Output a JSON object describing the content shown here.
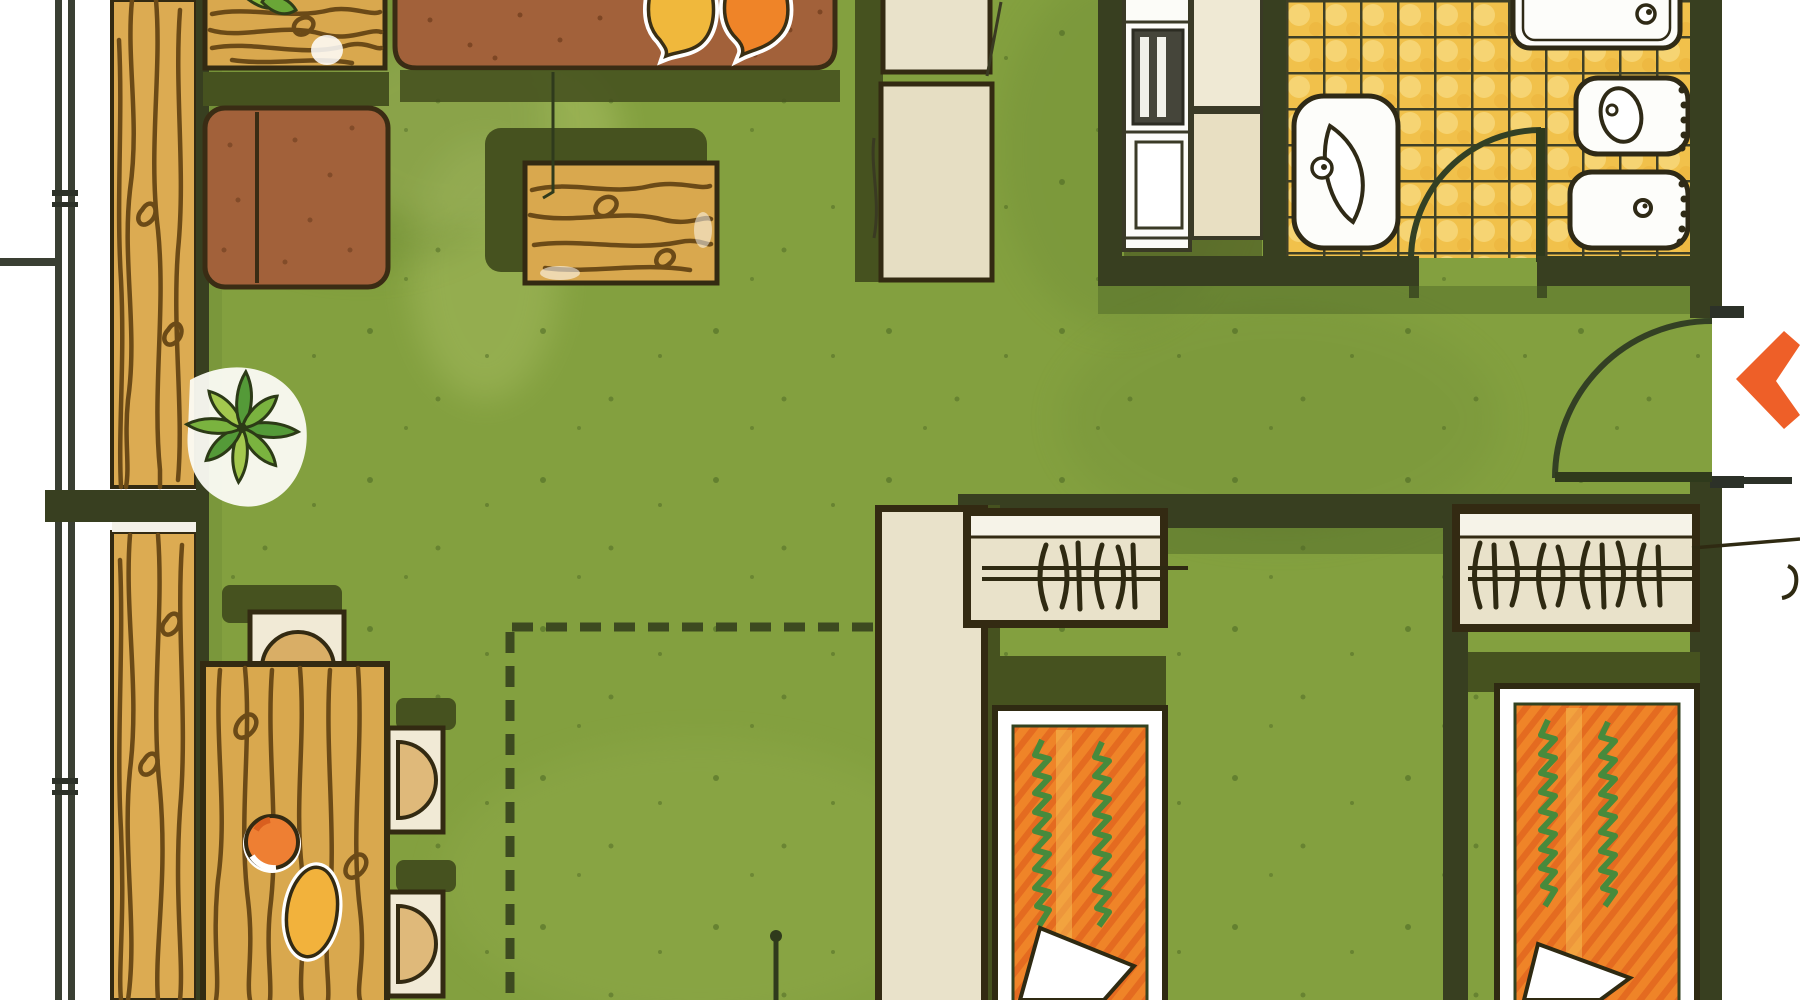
{
  "meta": {
    "kind": "hand-drawn apartment floor plan illustration",
    "view": "top-down marker rendering",
    "visible_text": "none (leader-line labels are cropped at image edges)"
  },
  "palette": {
    "floor_green": "#83a03f",
    "floor_green_light": "#9ab553",
    "shadow_olive": "#46521f",
    "wall_dark": "#383f20",
    "outline_dark": "#332a12",
    "wood_base": "#dcab52",
    "wood_grain": "#6b4a17",
    "upholstery_brown": "#a2613a",
    "bed_orange": "#ef8428",
    "bed_stripe": "#e2661f",
    "bed_zigzag_green": "#478a3c",
    "pillow_yellow": "#f0b83c",
    "pillow_orange": "#ef8428",
    "beige": "#e9e2ca",
    "beige_light": "#f1ead6",
    "tile_yellow": "#f1c14b",
    "tile_grid": "#3f4026",
    "fixture_white": "#fdfdfa",
    "arrow_orange": "#ee5f28",
    "plant_green": "#6fae3f",
    "exterior_white": "#ffffff"
  },
  "floor_plan": {
    "rooms": [
      {
        "id": "balcony",
        "features": [
          "wood plank decking strip",
          "outer railing with joint ticks",
          "dividing wall stub"
        ]
      },
      {
        "id": "living-room",
        "furniture": [
          "wood sideboard with plant leaves",
          "two-cushion brown armchair",
          "brown sofa-daybed with yellow and orange cushions",
          "wood coffee table with shadow"
        ]
      },
      {
        "id": "dining-area",
        "furniture": [
          "wood dining table",
          "head chair with half-round seat",
          "two side chairs with half-round seats",
          "round orange plate",
          "oval yellow platter"
        ],
        "annotation": "dashed L-shaped partition outline"
      },
      {
        "id": "hall-entrance",
        "furniture": [
          "beige storage column (upper)",
          "beige storage column (lower)"
        ],
        "features": [
          "entrance door with quarter-circle swing arc in right wall"
        ]
      },
      {
        "id": "kitchen",
        "furniture": [
          "white stove/oven unit with dark grill",
          "upper counter",
          "lower counter"
        ]
      },
      {
        "id": "bathroom",
        "furniture": [
          "bathtub with drain (cropped at top)",
          "wash basin with oval bowl and tap",
          "toilet with oval seat",
          "bidet with drain dot"
        ],
        "features": [
          "yellow tile grid floor",
          "door with quarter-circle swing arc"
        ]
      },
      {
        "id": "bedroom-1",
        "furniture": [
          "wardrobe with clothes-hanger symbols",
          "single bed, orange striped spread, green zigzags, white folded pillow"
        ]
      },
      {
        "id": "bedroom-2",
        "furniture": [
          "wardrobe with clothes-hanger symbols",
          "single bed, orange striped spread, green zigzags, white folded pillow"
        ]
      }
    ],
    "annotations": [
      "orange entrance arrow at right edge",
      "thin leader line onto coffee table",
      "leader line from wardrobe-2 running off right edge (label cropped)",
      "leader line with dot at bottom edge (label cropped)",
      "dashed partition outline around dining corner"
    ]
  }
}
